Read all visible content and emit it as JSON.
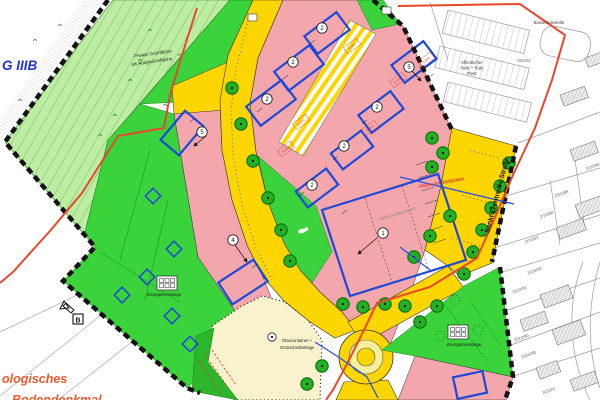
{
  "map": {
    "colors": {
      "pale_green": "#bdeca3",
      "bright_green": "#3bd33b",
      "housing_pink": "#f3a7ac",
      "road_yellow": "#fdd501",
      "utility_cream": "#f8f3cd",
      "tree_green": "#22b122",
      "envelope_blue": "#1d49d8",
      "boundary_red": "#e8472e",
      "zone_text_blue": "#2334cc",
      "archaeology_orange": "#f0572d"
    },
    "labels": {
      "zone_class": "G IIIB",
      "private_green_1": "Private Grünfläche",
      "private_green_2": "als Ausgleichsfläche",
      "bus_turnaround": "Buswendestelle",
      "park_ride_1": "öffentlicher",
      "park_ride_2": "Park + Ride",
      "park_ride_3": "Platz",
      "parking_area": "Fläche für Stellplätze",
      "street": "Sankt Erentrudis Straße",
      "market": "Lebensmittelmarkt",
      "allotments_left": "Kleingartenanlage",
      "allotments_right": "Kleingartenanlage",
      "recycling_1": "Glascontainer +",
      "recycling_2": "Grünschnittanlage",
      "archaeology_1": "ologisches",
      "archaeology_2": "Bodendenkmal",
      "section_marker": "B"
    },
    "building_numbers": [
      {
        "v": "2"
      },
      {
        "v": "2"
      },
      {
        "v": "2"
      },
      {
        "v": "2"
      },
      {
        "v": "5"
      },
      {
        "v": "2"
      },
      {
        "v": "2"
      },
      {
        "v": "5"
      },
      {
        "v": "4"
      },
      {
        "v": "1"
      }
    ],
    "parcel_numbers": [
      {
        "t": "5324/3"
      },
      {
        "t": "2/10/96"
      },
      {
        "t": "2/10/95"
      },
      {
        "t": "2/10/94"
      },
      {
        "t": "2/10/53"
      },
      {
        "t": "3110/92"
      },
      {
        "t": "3110/91"
      },
      {
        "t": "3110/90"
      },
      {
        "t": "3110/58"
      },
      {
        "t": "3110/4"
      }
    ],
    "zoning_codes": [
      {
        "t": "0,4/IV"
      },
      {
        "t": "0,4/IV"
      },
      {
        "t": "0,4/III"
      },
      {
        "t": "0,4/IV"
      },
      {
        "t": "0,4/III"
      },
      {
        "t": "0,4/IV"
      }
    ]
  }
}
